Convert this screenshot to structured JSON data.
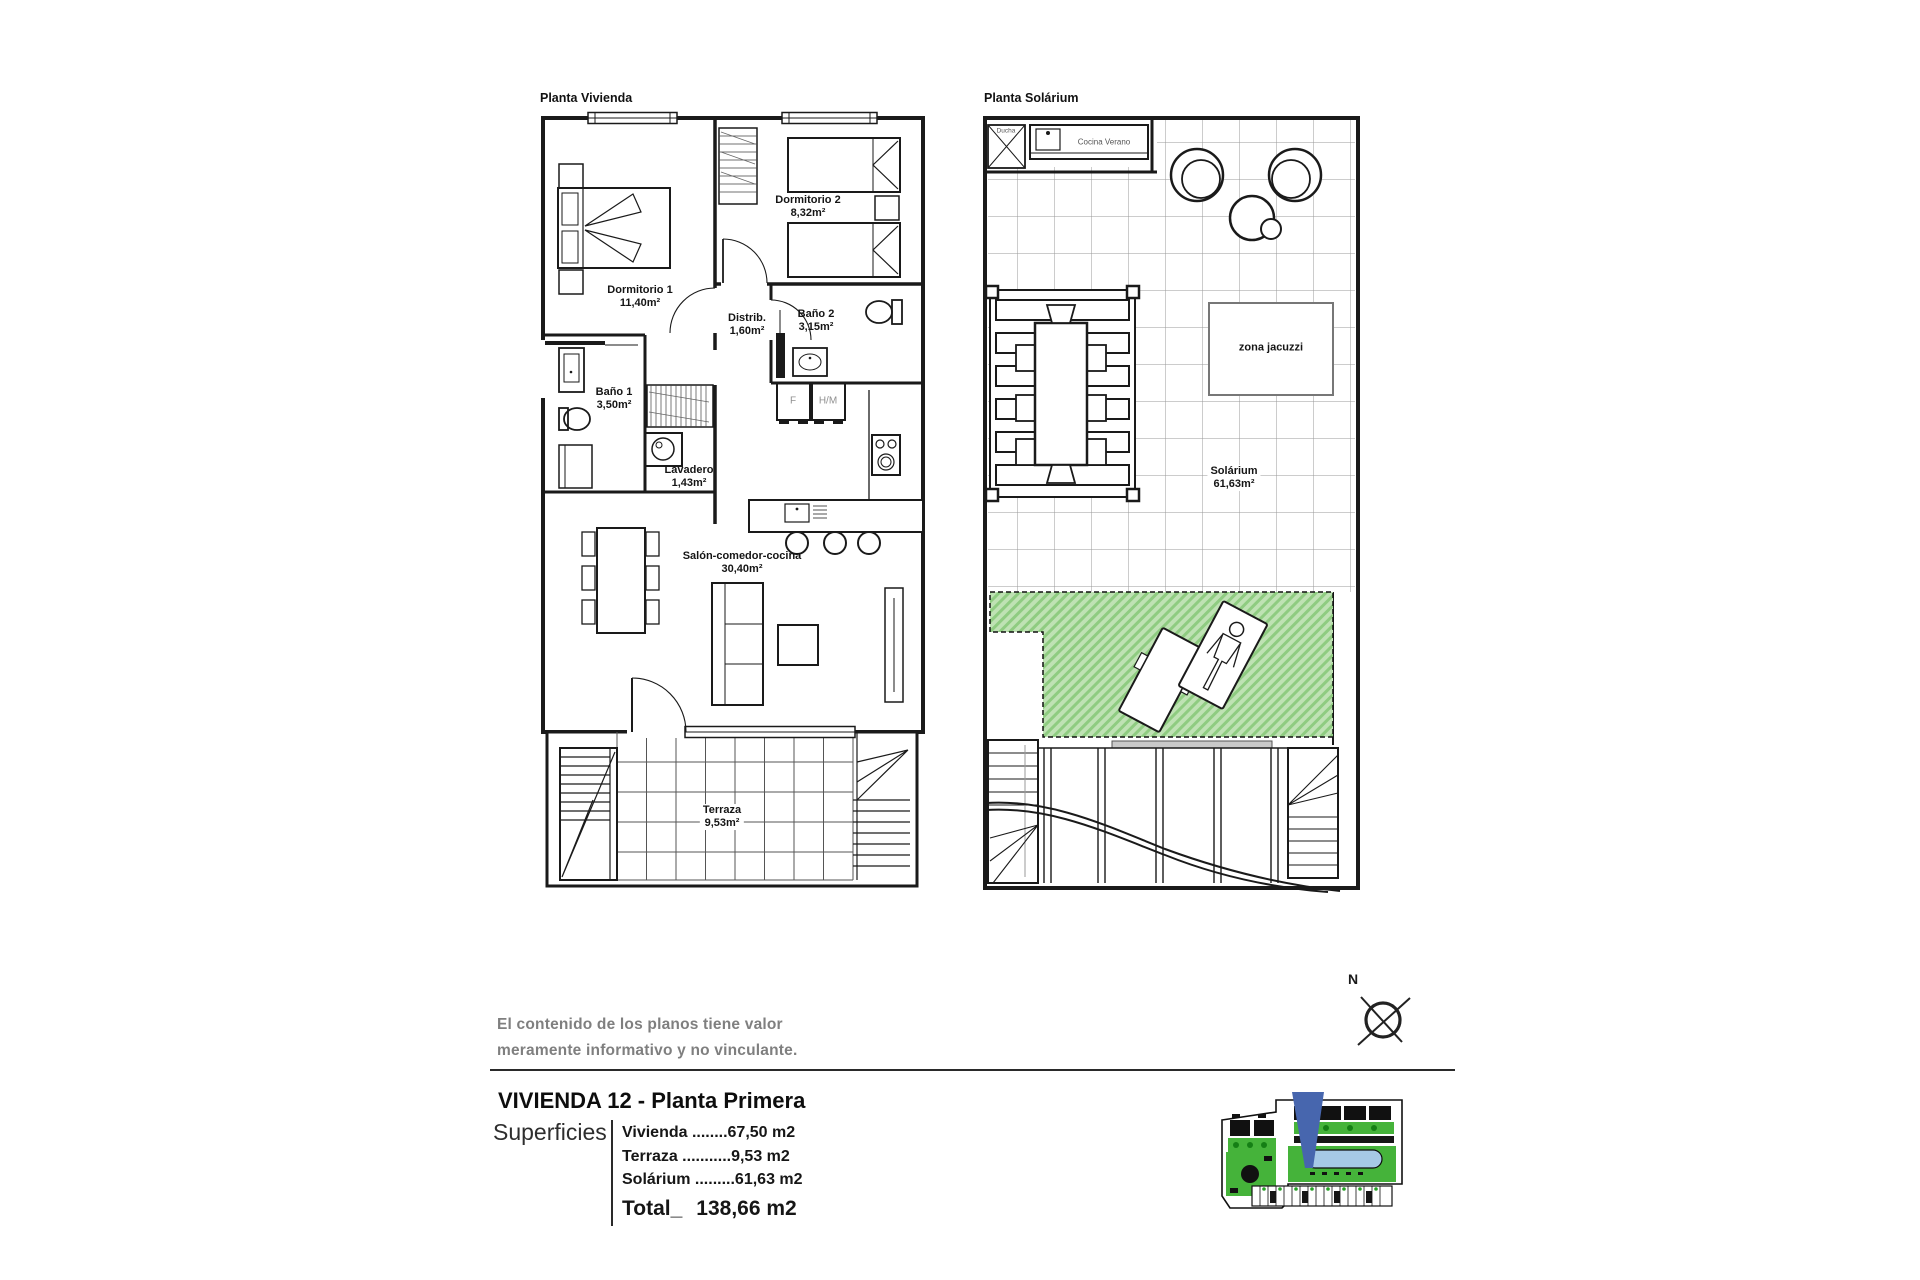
{
  "plans": {
    "vivienda": {
      "title": "Planta Vivienda",
      "rooms": [
        {
          "name": "Dormitorio 1",
          "area": "11,40m²"
        },
        {
          "name": "Dormitorio 2",
          "area": "8,32m²"
        },
        {
          "name": "Distrib.",
          "area": "1,60m²"
        },
        {
          "name": "Baño 2",
          "area": "3,15m²"
        },
        {
          "name": "Baño 1",
          "area": "3,50m²"
        },
        {
          "name": "Lavadero",
          "area": "1,43m²"
        },
        {
          "name": "Salón-comedor-cocina",
          "area": "30,40m²"
        },
        {
          "name": "Terraza",
          "area": "9,53m²"
        }
      ],
      "appliances": {
        "fridge": "F",
        "washer_column": "H/M"
      }
    },
    "solarium": {
      "title": "Planta Solárium",
      "labels": {
        "shower": "Ducha",
        "summer_kitchen": "Cocina Verano",
        "jacuzzi_zone": "zona jacuzzi"
      },
      "rooms": [
        {
          "name": "Solárium",
          "area": "61,63m²"
        }
      ]
    }
  },
  "disclaimer": {
    "line1": "El contenido de los planos tiene valor",
    "line2": "meramente informativo y no vinculante."
  },
  "summary": {
    "heading": "VIVIENDA 12 - Planta Primera",
    "label": "Superficies",
    "rows": [
      {
        "name": "Vivienda",
        "dots": " ........",
        "value": "67,50 m2"
      },
      {
        "name": "Terraza",
        "dots": " ...........",
        "value": "9,53 m2"
      },
      {
        "name": "Solárium",
        "dots": " .........",
        "value": "61,63 m2"
      }
    ],
    "total_label": "Total_",
    "total_value": "138,66 m2"
  },
  "compass": {
    "north_label": "N"
  },
  "colors": {
    "wall": "#1a1a1a",
    "tile_grid": "#9a9a9a",
    "terrace_grid": "#555555",
    "green_fill": "#bfe2b4",
    "green_stripe": "#8fcc81",
    "site_green": "#45b33a",
    "site_pool": "#a6c9e6",
    "site_marker_blue": "#4766ae"
  }
}
